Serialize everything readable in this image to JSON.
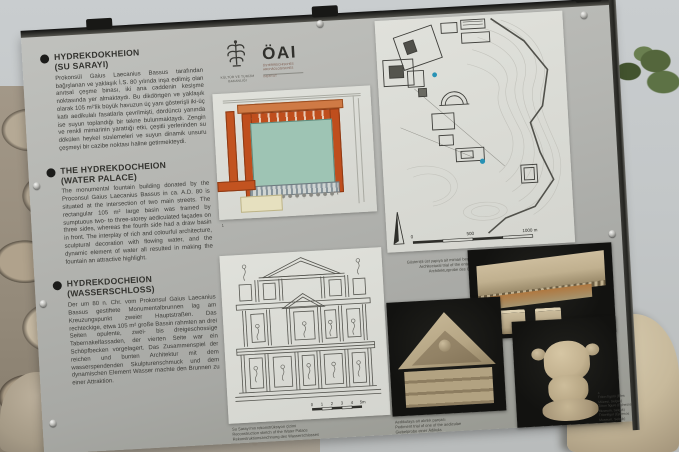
{
  "panel": {
    "colors": {
      "panel_gray": "#b3b4b0",
      "accent_orange": "#bf4e1d",
      "basin_teal": "#9ec4b4",
      "photo_black": "#141412",
      "map_marker_blue": "#2892b5"
    },
    "sections": [
      {
        "lang": "tr",
        "title": "HYDREKDOKHEION",
        "subtitle": "(SU SARAYI)",
        "body": "Prokonsül Gaius Laecanius Bassus tarafından bağışlanan ve yaklaşık İ.S. 80 yılında inşa edilmiş olan anıtsal çeşme binası, iki ana caddenin kesişme noktasında yer almaktaydı. Bu dikdörtgen ve yaklaşık olarak 105 m²'lik büyük havuzun üç yanı gösterişli iki-üç katlı aedikulalı fasatlarla çevrilmişti, dördüncü yanında ise suyun toplandığı bir tekne bulunmaktaydı. Zengin ve renkli mimarinin yarattığı etki, çeşitli yerlerinden su dökülen heykel süslemeleri ve suyun dinamik unsuru çeşmeyi bir cazibe noktası haline getirmekteydi."
      },
      {
        "lang": "en",
        "title": "THE HYDREKDOCHEION",
        "subtitle": "(WATER PALACE)",
        "body": "The monumental fountain building donated by the Proconsul Gaius Laecanius Bassus in ca. A.D. 80 is situated at the intersection of two main streets. The rectangular 105 m² large basin was framed by sumptuous two- to three-storey aediculated façades on three sides, whereas the fourth side had a draw basin in front. The interplay of rich and colourful architecture, sculptural decoration with flowing water, and the dynamic element of water all resulted in making the fountain an attractive highlight."
      },
      {
        "lang": "de",
        "title": "HYDREKDOCHEION",
        "subtitle": "(WASSERSCHLOSS)",
        "body": "Der um 80 n. Chr. vom Prokonsul Gaius Laecanius Bassus gestiftete Monumentalbrunnen lag am Kreuzungspunkt zweier Hauptstraßen. Das rechteckige, etwa 105 m² große Bassin rahmten an drei Seiten opulente, zwei- bis dreigeschossige Tabernakelfassaden, der vierten Seite war ein Schöpfbecken vorgelagert. Das Zusammenspiel der reichen und bunten Architektur mit dem wasserspendenden Skulpturenschmuck und dem dynamischen Element Wasser machte den Brunnen zu einer Attraktion."
      }
    ],
    "logos": {
      "ministry_caption": "KÜLTÜR VE TURİZM BAKANLIĞI",
      "oai_wordmark": "ÖAI",
      "oai_subtext_lines": [
        "ÖSTERREICHISCHES",
        "ARCHÄOLOGISCHES",
        "INSTITUT"
      ]
    },
    "figures": {
      "plan": {
        "caption": "1"
      },
      "site_map": {
        "scale_labels": [
          "0",
          "500",
          "1000 m"
        ]
      },
      "facade": {
        "scale_labels": [
          "0",
          "1",
          "2",
          "3",
          "4",
          "5m"
        ],
        "caption_lines": [
          "Su Sarayı'nın rekonstrüksiyon çizimi",
          "Reconstruction sketch of the Water Palace",
          "Rekonstruktionszeichnung des Wasserschlosses"
        ]
      },
      "photo_entablature": {
        "caption_lines": [
          "Gösterişli üst yapıya ait mimari bezemeler",
          "Architectural trial of the entablature",
          "Architekturprobe des Gebälks"
        ]
      },
      "photo_pediment": {
        "caption_lines": [
          "Aedikulaya ait alınlık parçası",
          "Pediment trial of one of the aediculae",
          "Giebelprobe einer Ädikula"
        ]
      },
      "photo_torso": {
        "caption_lines": [
          "4",
          "Triton figürü (Efes Müzesi, Selçuk)",
          "Triton figure (Ephesos Museum, Selçuk)",
          "Tritonfigur (Ephesos Museum, Selçuk)"
        ]
      }
    }
  }
}
